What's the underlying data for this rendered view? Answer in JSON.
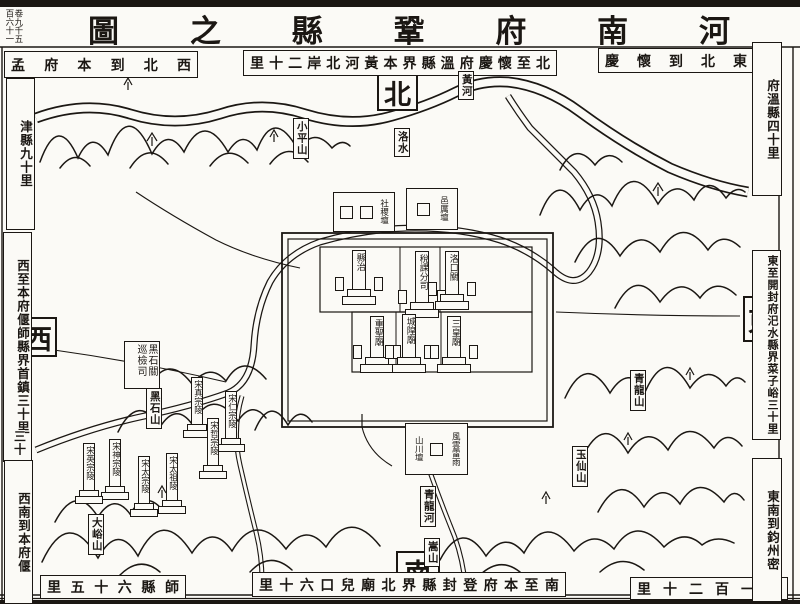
{
  "palette": {
    "ink": "#1b1713",
    "paper": "#fbfaf6"
  },
  "corner_note": "卷九千五百六十一",
  "title": "河南府鞏縣之圖",
  "cardinals": {
    "north": "北",
    "south": "南",
    "east": "東",
    "west": "西"
  },
  "border_notes": {
    "northwest": "西北到本府孟",
    "northwest_v": "津縣九十里",
    "north": "北至懷慶府溫縣界本黃河北岸二十里",
    "northeast": "東北到懷慶",
    "northeast_v": "府溫縣四十里",
    "west": "西至本府偃師縣界首鎮三十里",
    "west_extra": "三十",
    "southwest_v": "西南到本府偃",
    "southwest": "師縣六十五里",
    "south": "南至本府登封縣界北廟兒口六十里",
    "southeast": "縣一百二十里",
    "southeast_v": "東南到鈞州密",
    "east": "東至開封府汜水縣界菜子峪三十里"
  },
  "rivers": {
    "huang_he": "黃河",
    "luo_shui": "洛水",
    "qinglong_he": "青龍河"
  },
  "mountains": {
    "xiaoping": "小平山",
    "heishi": "黑石山",
    "qinglong": "青龍山",
    "yuxian": "玉仙山",
    "dayu": "大峪山",
    "song": "嵩山"
  },
  "city": {
    "xianzhi": "縣治",
    "shuike": "稅課分司",
    "luokou": "洛口關",
    "zhongsheng": "重聖廟",
    "chenghuang": "城隍廟",
    "sanhuang": "三皇廟"
  },
  "altars": {
    "sheji": "社稷壇",
    "yili": "邑厲壇",
    "fengyun": "風雲雷雨",
    "shanchuan": "山川壇"
  },
  "offices": {
    "xunjian": "黑石關巡檢司"
  },
  "tombs": {
    "taizu": "宋太祖陵",
    "taizong": "宋太宗陵",
    "zhenzong": "宋真宗陵",
    "renzong": "宋仁宗陵",
    "yingzong": "宋英宗陵",
    "shenzong": "宋神宗陵",
    "zhezong": "宋哲宗陵"
  }
}
